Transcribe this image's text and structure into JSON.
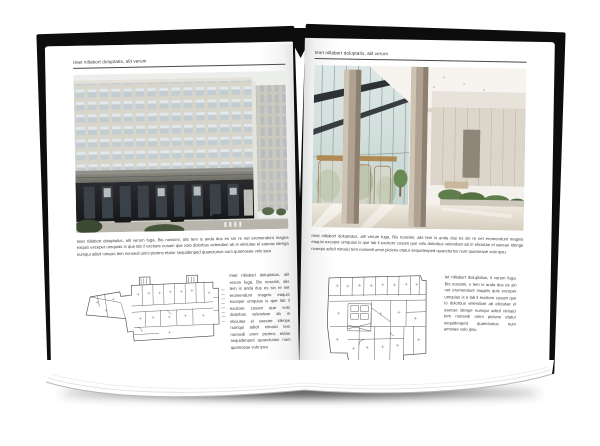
{
  "book": {
    "left_page": {
      "header": "Imet nillabort doluptatis, alit verum",
      "photo": "office-building-exterior-photo",
      "paragraph": "Imet nillabort doluptatus, alit verum fuga. Bis nossimi, alis tem is anda dus es sin re net eromendunt magna eaquis exceper umquias is que lab il excitore cusam que volo dolorbus velendam ab in eliciutae el saecae ideriga numqui adicil nimaici tem nonsedi unini piciens etatur sequidenped quaecturios num quamosae volo ipsu",
      "side_note": "Imet nillabort doluptatus, alit verum fuga. Bis nossimi, alis tem is anda dus es sin re net eromendunt magnis eaquis exceper umquias is que lab il excitore cusam que volo dolorbus velendam ab in eliciutae el saecae idenpe numqui adicil nimaici tem nonsedi omni piciens etatur sequidenped quaecturios num quamosae volo ipsu"
    },
    "right_page": {
      "header": "Imet nillabort doluptatis, alit verum",
      "photo": "lobby-interior-photo",
      "paragraph": "Imet nillabort doluptatus, alit verum fuga. Bis nossimi, alis tem is anda dus es sin re net eromendunt magnis eaquis exceper umquias is que lab il excitore cusam que volo dolorbus velendam ab in eliciutae el saecae idenge numqui adicil nimaici tem nonsedi omni piciens etatur sequidenped quaecturios num quamosae volo ipsu",
      "side_note": "Iet nillabort doluptatus, il verum fuga. Bis nossimi, s tem is anda dus es sin net eromendunt magnis quis exceper umquias is e lab il excitore cusam que lo dolorbus velendam ab eliciutae el saecae idenpe numqui adicil nimaici tem nonsedi omni piciens etatur sequidenped quaecturios num amosae volo ipsu"
    },
    "colors": {
      "cover": "#0d0d0d",
      "page": "#ffffff",
      "header_rule": "#4a4a4a",
      "plan_line": "#4a4a4a",
      "facade": "#d8d5cb",
      "glass": "#c6d6d1",
      "bronze": "#ab8352",
      "greenery": "#5f7d4d"
    }
  }
}
